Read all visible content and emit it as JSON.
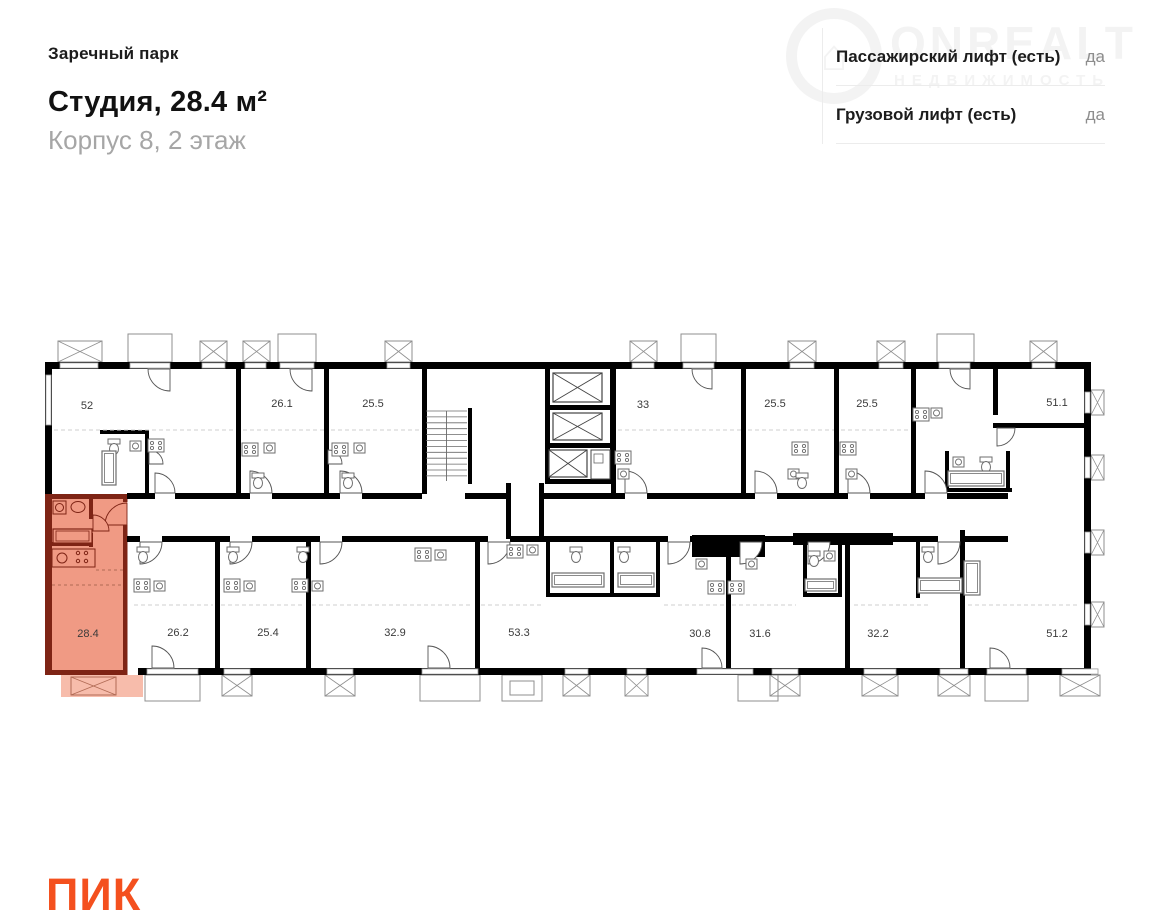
{
  "header": {
    "project": "Заречный парк",
    "title": "Студия, 28.4 м²",
    "subtitle": "Корпус 8, 2 этаж"
  },
  "lifts": {
    "rows": [
      {
        "label": "Пассажирский лифт (есть)",
        "value": "да"
      },
      {
        "label": "Грузовой лифт (есть)",
        "value": "да"
      }
    ]
  },
  "watermark": {
    "icon": "house-icon",
    "line1": "ONREALT",
    "line2": "НЕДВИЖИМОСТЬ"
  },
  "logo": {
    "text": "ПИК",
    "color": "#f4501e"
  },
  "floor_plan": {
    "highlight_color": "#f09a84",
    "highlight_balcony_color": "#f7bcab",
    "highlight_wall_color": "#7e2415",
    "wall_color": "#000000",
    "label_color": "#3a3a3a",
    "highlighted_unit_label": "28.4",
    "units": [
      {
        "label": "52",
        "x": 47,
        "y": 76,
        "row": "top",
        "highlighted": false
      },
      {
        "label": "26.1",
        "x": 242,
        "y": 74,
        "row": "top",
        "highlighted": false
      },
      {
        "label": "25.5",
        "x": 333,
        "y": 74,
        "row": "top",
        "highlighted": false
      },
      {
        "label": "33",
        "x": 603,
        "y": 75,
        "row": "top",
        "highlighted": false
      },
      {
        "label": "25.5",
        "x": 735,
        "y": 74,
        "row": "top",
        "highlighted": false
      },
      {
        "label": "25.5",
        "x": 827,
        "y": 74,
        "row": "top",
        "highlighted": false
      },
      {
        "label": "51.1",
        "x": 1017,
        "y": 73,
        "row": "top",
        "highlighted": false
      },
      {
        "label": "28.4",
        "x": 48,
        "y": 304,
        "row": "bottom",
        "highlighted": true
      },
      {
        "label": "26.2",
        "x": 138,
        "y": 303,
        "row": "bottom",
        "highlighted": false
      },
      {
        "label": "25.4",
        "x": 228,
        "y": 303,
        "row": "bottom",
        "highlighted": false
      },
      {
        "label": "32.9",
        "x": 355,
        "y": 303,
        "row": "bottom",
        "highlighted": false
      },
      {
        "label": "53.3",
        "x": 479,
        "y": 303,
        "row": "bottom",
        "highlighted": false
      },
      {
        "label": "30.8",
        "x": 660,
        "y": 304,
        "row": "bottom",
        "highlighted": false
      },
      {
        "label": "31.6",
        "x": 720,
        "y": 304,
        "row": "bottom",
        "highlighted": false
      },
      {
        "label": "32.2",
        "x": 838,
        "y": 304,
        "row": "bottom",
        "highlighted": false
      },
      {
        "label": "51.2",
        "x": 1017,
        "y": 304,
        "row": "bottom",
        "highlighted": false
      }
    ]
  }
}
